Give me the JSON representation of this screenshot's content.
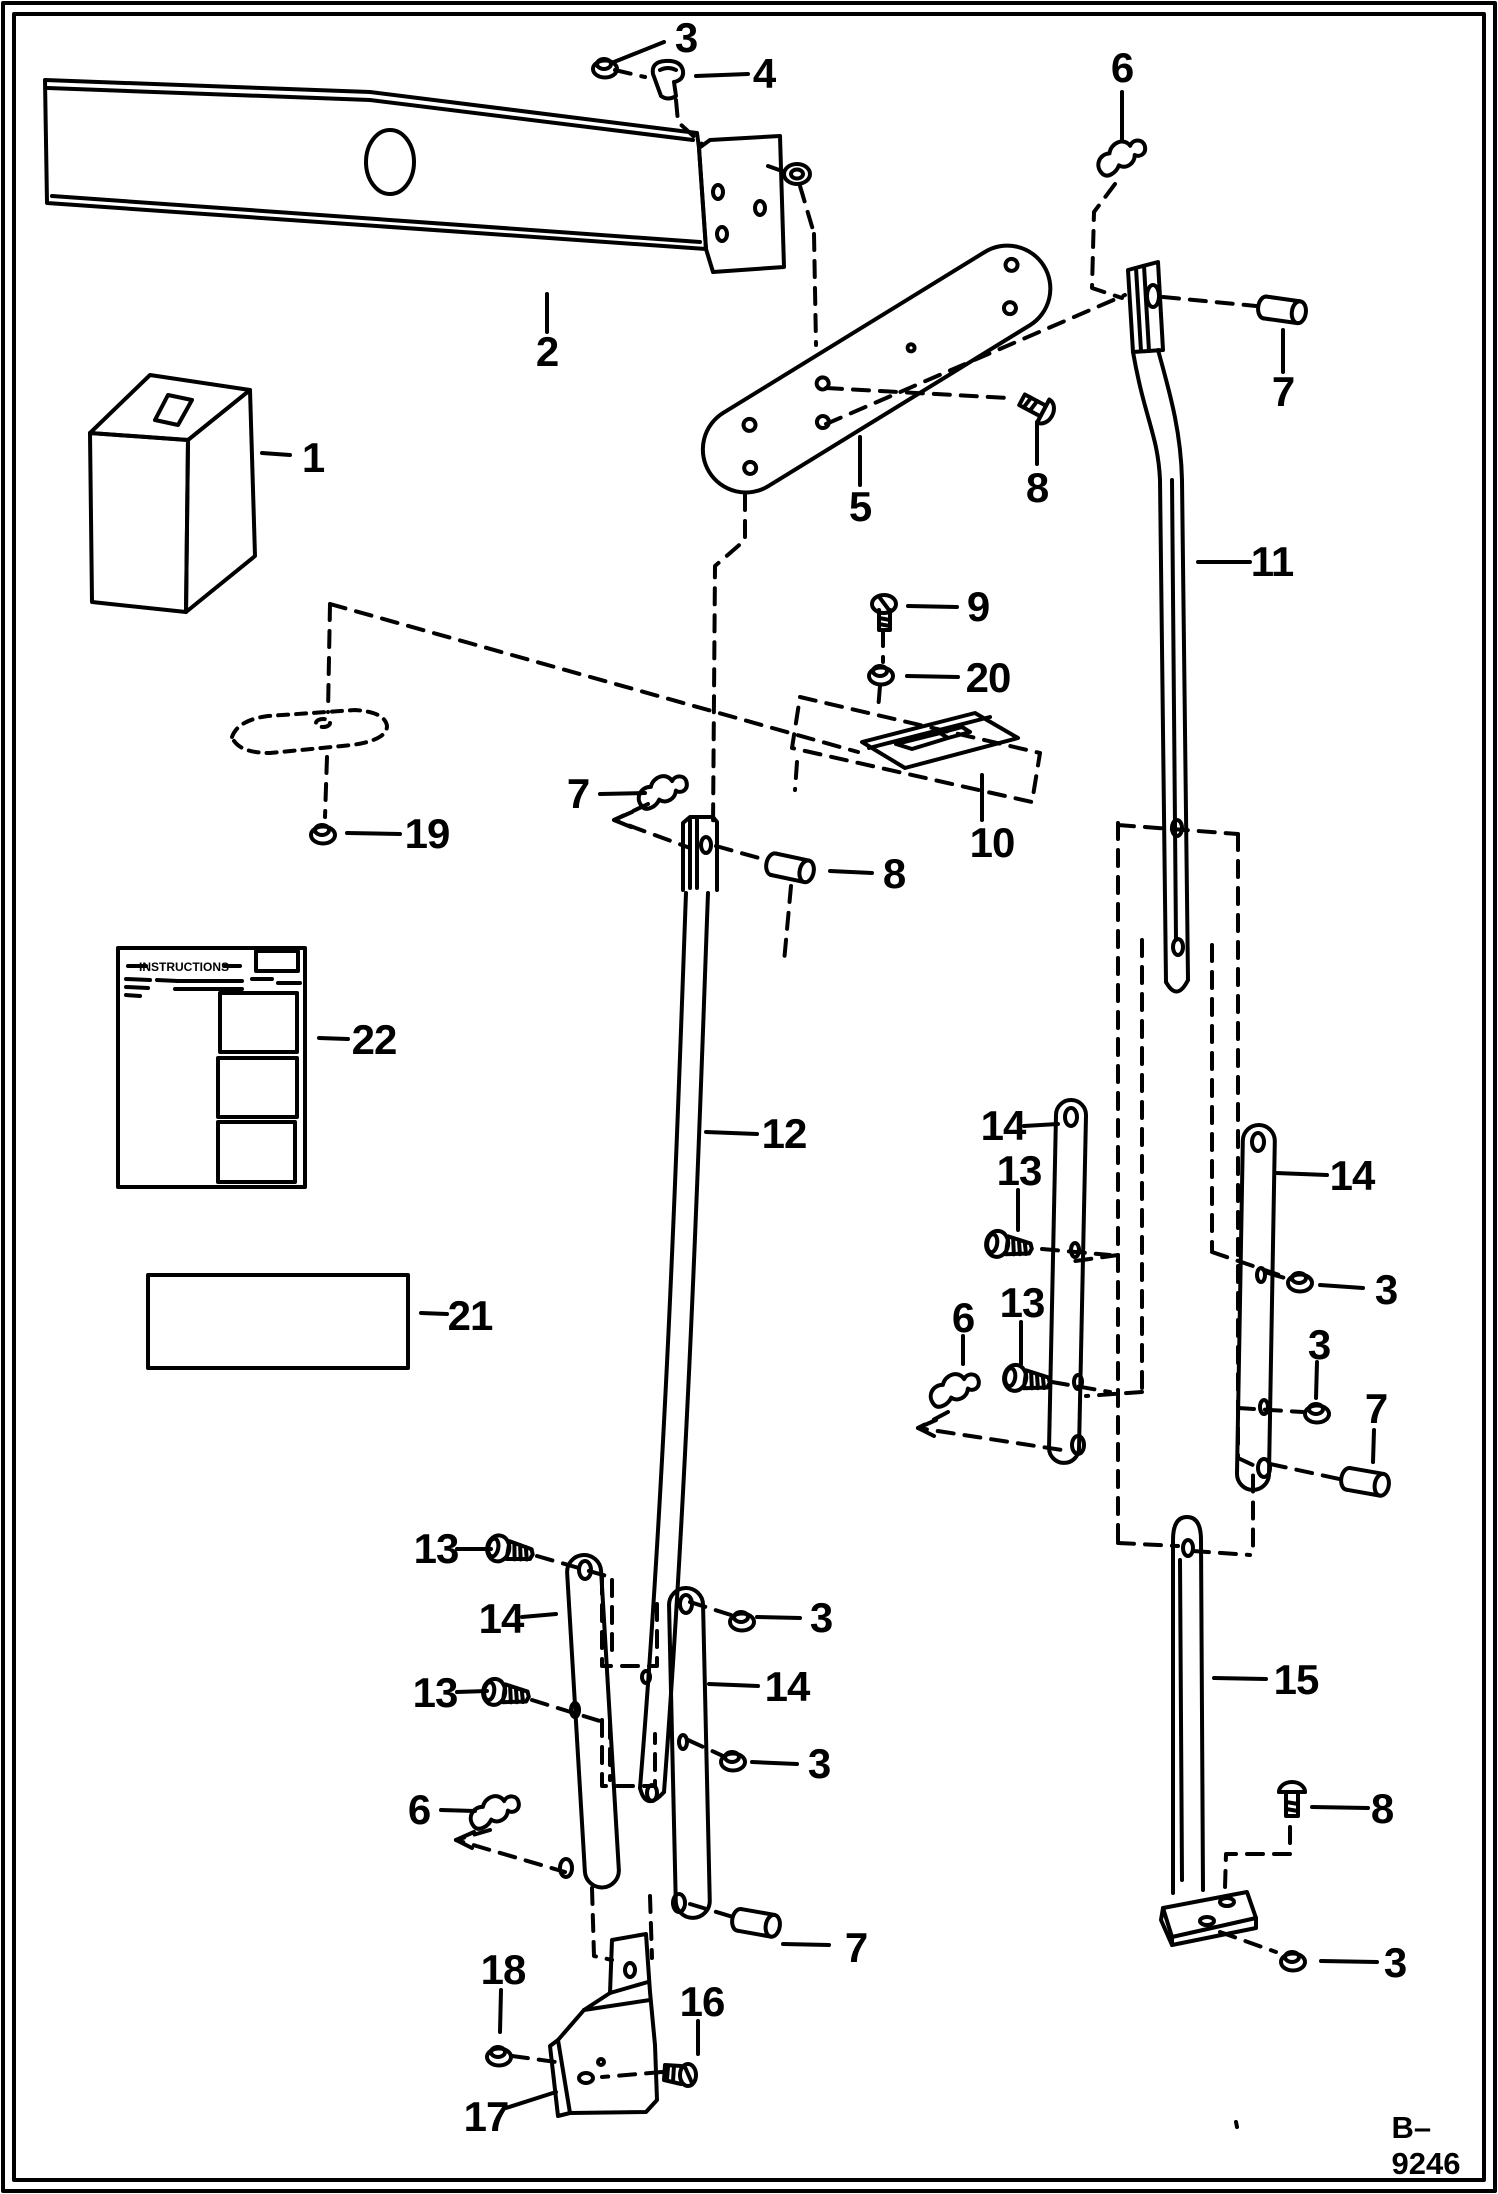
{
  "figure": {
    "code": "B–9246"
  },
  "instruction_sheet": {
    "title": "INSTRUCTIONS"
  },
  "callouts": [
    {
      "label": "3"
    },
    {
      "label": "4"
    },
    {
      "label": "6"
    },
    {
      "label": "2"
    },
    {
      "label": "7"
    },
    {
      "label": "1"
    },
    {
      "label": "5"
    },
    {
      "label": "8"
    },
    {
      "label": "11"
    },
    {
      "label": "9"
    },
    {
      "label": "20"
    },
    {
      "label": "7"
    },
    {
      "label": "10"
    },
    {
      "label": "8"
    },
    {
      "label": "19"
    },
    {
      "label": "12"
    },
    {
      "label": "22"
    },
    {
      "label": "21"
    },
    {
      "label": "14"
    },
    {
      "label": "13"
    },
    {
      "label": "13"
    },
    {
      "label": "6"
    },
    {
      "label": "14"
    },
    {
      "label": "3"
    },
    {
      "label": "3"
    },
    {
      "label": "7"
    },
    {
      "label": "13"
    },
    {
      "label": "14"
    },
    {
      "label": "13"
    },
    {
      "label": "3"
    },
    {
      "label": "14"
    },
    {
      "label": "6"
    },
    {
      "label": "3"
    },
    {
      "label": "15"
    },
    {
      "label": "7"
    },
    {
      "label": "8"
    },
    {
      "label": "3"
    },
    {
      "label": "18"
    },
    {
      "label": "16"
    },
    {
      "label": "17"
    }
  ]
}
